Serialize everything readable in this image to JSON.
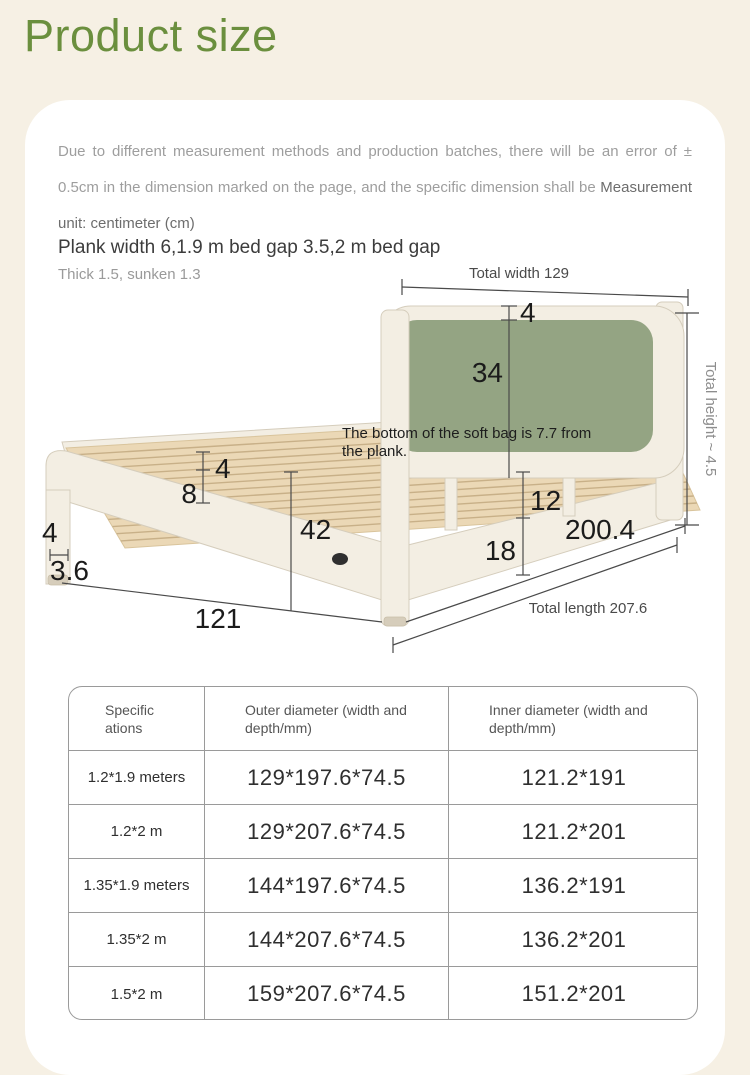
{
  "page": {
    "title": "Product size",
    "colors": {
      "background": "#f6f0e4",
      "card": "#ffffff",
      "title_green": "#6b8f3e"
    }
  },
  "disclaimer": {
    "text": "Due to different measurement methods and production batches, there will be an error of ± 0.5cm in the dimension marked on the page, and the specific dimension shall be ",
    "unit_note": "Measurement unit: centimeter (cm)"
  },
  "diagram": {
    "heading": "Plank width 6,1.9 m bed gap 3.5,2 m bed gap",
    "subheading": "Thick 1.5, sunken 1.3",
    "colors": {
      "headboard_green": "#94a483",
      "frame_cream": "#f3eee3",
      "slat_wood": "#ebd8b6"
    },
    "labels": {
      "total_width": "Total width 129",
      "headboard_top_gap": "4",
      "headboard_panel_height": "34",
      "note_line1": "The bottom of the soft bag is 7.7 from",
      "note_line2": "the plank.",
      "total_height": "Total height ~ 4.5",
      "slat_thickness": "4",
      "slat_gap": "8",
      "frame_height": "42",
      "rail_top": "12",
      "rail_bottom": "18",
      "inner_length": "200.4",
      "total_length": "Total length 207.6",
      "leg_width": "4",
      "leg_glide": "3.6",
      "footboard_width": "121"
    }
  },
  "table": {
    "headers": [
      "Specific\nations",
      "Outer diameter (width and\ndepth/mm)",
      "Inner diameter (width and\ndepth/mm)"
    ],
    "rows": [
      {
        "spec": "1.2*1.9 meters",
        "outer": "129*197.6*74.5",
        "inner": "121.2*191"
      },
      {
        "spec": "1.2*2 m",
        "outer": "129*207.6*74.5",
        "inner": "121.2*201"
      },
      {
        "spec": "1.35*1.9 meters",
        "outer": "144*197.6*74.5",
        "inner": "136.2*191"
      },
      {
        "spec": "1.35*2 m",
        "outer": "144*207.6*74.5",
        "inner": "136.2*201"
      },
      {
        "spec": "1.5*2 m",
        "outer": "159*207.6*74.5",
        "inner": "151.2*201"
      }
    ]
  }
}
